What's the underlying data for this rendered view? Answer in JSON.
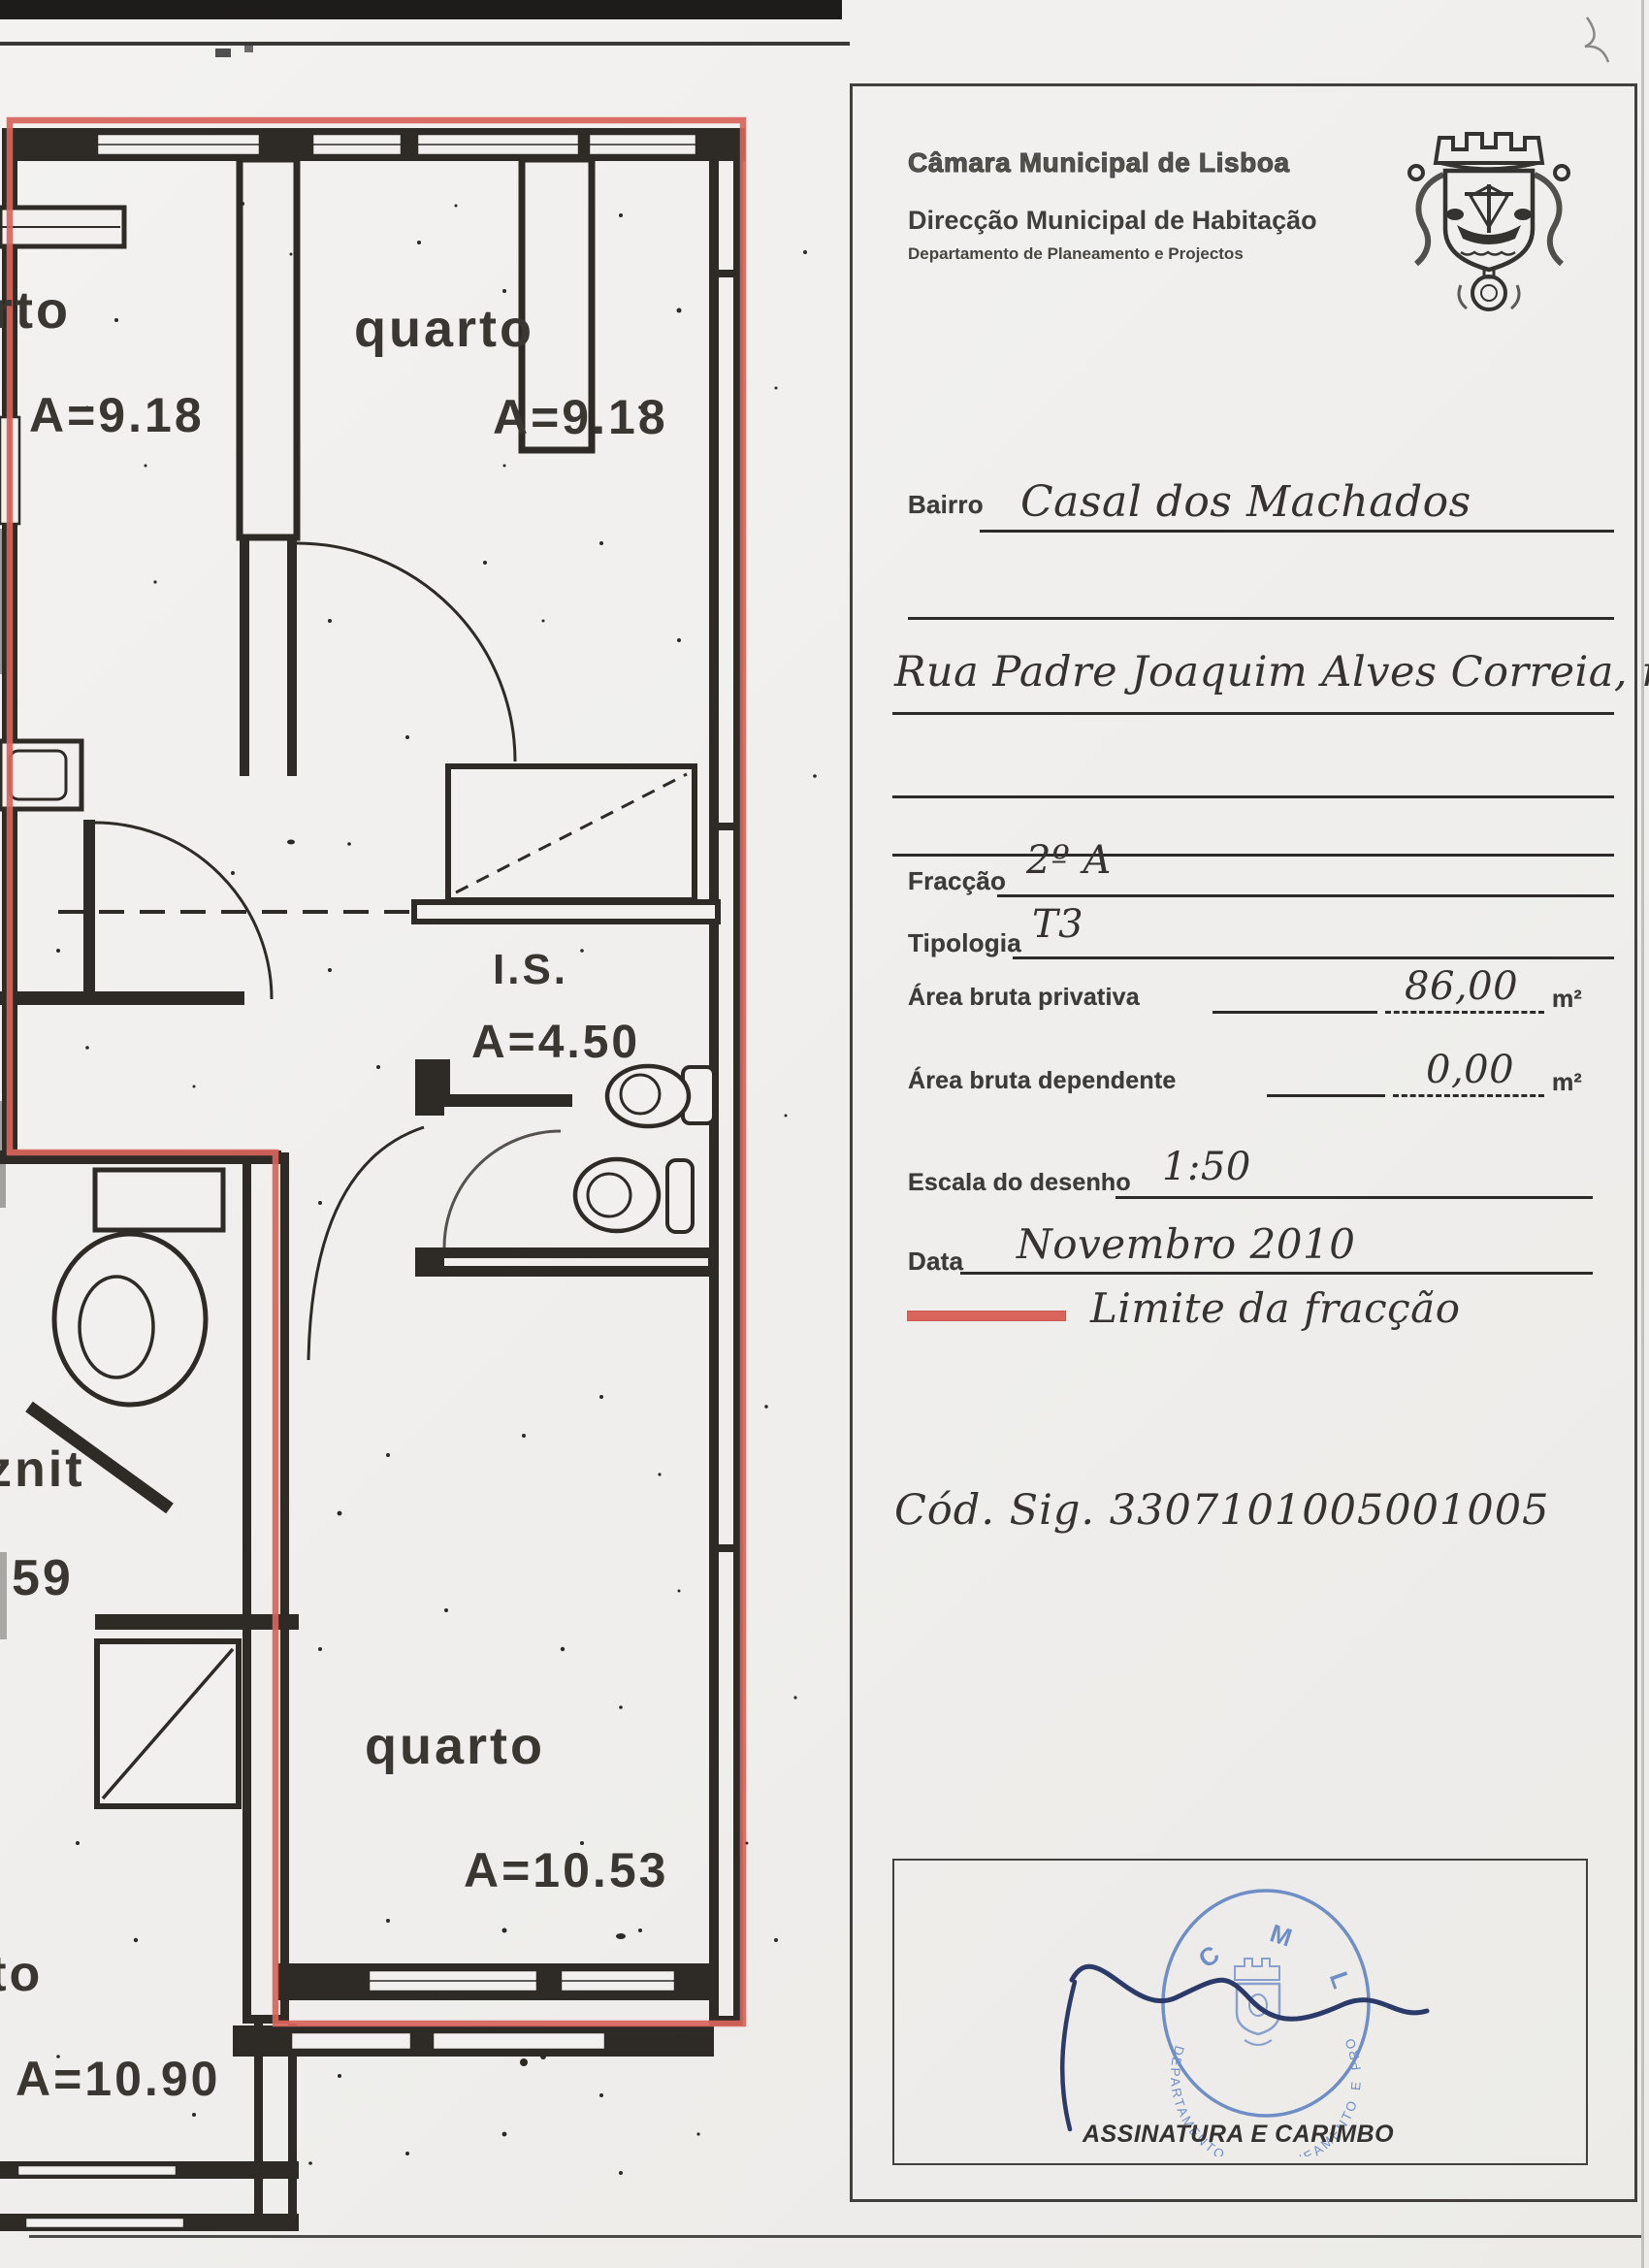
{
  "header": {
    "municipality": "Câmara Municipal de Lisboa",
    "direction": "Direcção Municipal de Habitação",
    "department": "Departamento de Planeamento e Projectos",
    "crest": "lisbon-coat-of-arms"
  },
  "form": {
    "bairro": {
      "label": "Bairro",
      "value": "Casal dos Machados"
    },
    "address": {
      "value": "Rua Padre Joaquim Alves Correia, nº 6"
    },
    "fraccao": {
      "label": "Fracção",
      "value": "2º A"
    },
    "tipologia": {
      "label": "Tipologia",
      "value": "T3"
    },
    "area_bruta_privativa": {
      "label": "Área bruta privativa",
      "value": "86,00",
      "unit": "m²"
    },
    "area_bruta_dependente": {
      "label": "Área bruta dependente",
      "value": "0,00",
      "unit": "m²"
    },
    "escala": {
      "label": "Escala do desenho",
      "value": "1:50"
    },
    "data": {
      "label": "Data",
      "value": "Novembro 2010"
    },
    "legend": {
      "label": "Limite da fracção",
      "color": "#d8645c"
    },
    "cod_sig": {
      "value": "Cód. Sig. 3307101005001005"
    },
    "signature": {
      "caption": "ASSINATURA E CARIMBO"
    }
  },
  "stamp": {
    "org": "C M L",
    "ring_text": "DEPARTAMENTO DE PLANEAMENTO E PROJECTOS",
    "color": "#5b7ec0",
    "signature_color": "#2c3a69"
  },
  "floorplan": {
    "boundary_color": "#d8645c",
    "wall_color": "#2e2a26",
    "scale": "1:50",
    "labels": [
      {
        "id": "bedroom-left-name",
        "text": "rto"
      },
      {
        "id": "bedroom-left-area",
        "text": "A=9.18"
      },
      {
        "id": "bedroom-middle-name",
        "text": "quarto"
      },
      {
        "id": "bedroom-middle-area",
        "text": "A=9.18"
      },
      {
        "id": "bathroom-name",
        "text": "I.S."
      },
      {
        "id": "bathroom-area",
        "text": "A=4.50"
      },
      {
        "id": "wc-name",
        "text": "znit"
      },
      {
        "id": "wc-area",
        "text": "59"
      },
      {
        "id": "bedroom-bottom-name",
        "text": "quarto"
      },
      {
        "id": "bedroom-bottom-area",
        "text": "A=10.53"
      },
      {
        "id": "neighbor-room-name",
        "text": "rto"
      },
      {
        "id": "neighbor-room-area",
        "text": "A=10.90"
      }
    ]
  }
}
